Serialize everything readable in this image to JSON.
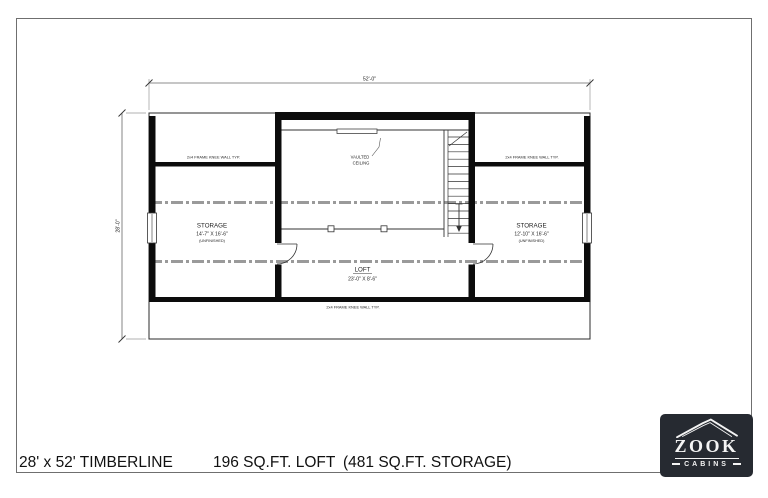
{
  "footer": {
    "model": "28' x 52' TIMBERLINE",
    "loft": "196 SQ.FT. LOFT",
    "storage": "(481 SQ.FT. STORAGE)"
  },
  "logo": {
    "brand": "ZOOK",
    "sub": "CABINS",
    "background": "#262a31"
  },
  "plan": {
    "dim_width": "52'-0\"",
    "dim_height": "28'-0\"",
    "vaulted_1": "VAULTED",
    "vaulted_2": "CEILING",
    "knee_wall_note": "2x4 FRAME KNEE WALL TYP.",
    "loft_name": "LOFT",
    "loft_size": "23'-0\" X 8'-6\"",
    "storage_left_name": "STORAGE",
    "storage_left_size": "14'-7\" X 16'-6\"",
    "storage_left_note": "(UNFINISHED)",
    "storage_right_name": "STORAGE",
    "storage_right_size": "12'-10\" X 16'-6\"",
    "storage_right_note": "(UNFINISHED)",
    "line_colors": {
      "wall": "#0c0c0c",
      "thin": "#333333",
      "dashed_roof": "#9a9a9a",
      "dimension": "#666666"
    }
  }
}
